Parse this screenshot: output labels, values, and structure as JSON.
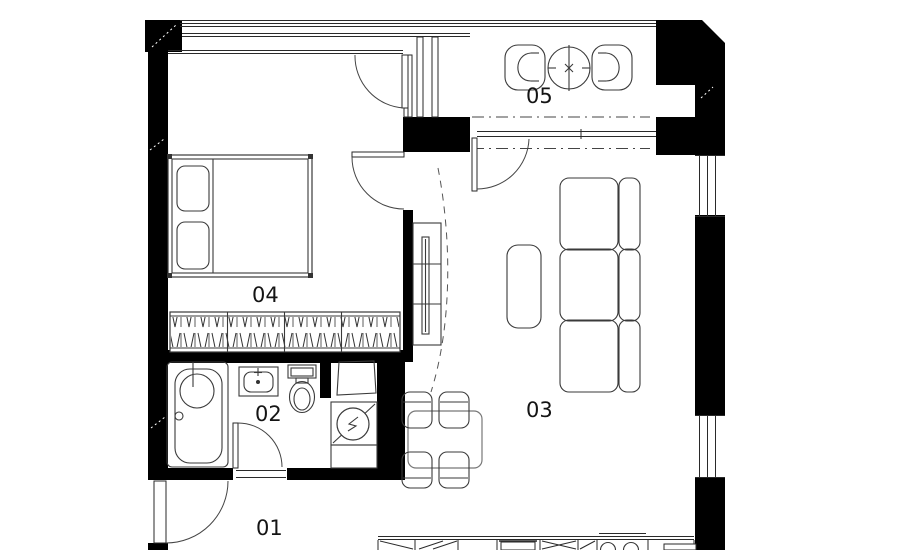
{
  "floor_plan": {
    "rooms": [
      {
        "label": "01"
      },
      {
        "label": "02"
      },
      {
        "label": "03"
      },
      {
        "label": "04"
      },
      {
        "label": "05"
      }
    ],
    "colors": {
      "wall": "#000000",
      "line": "#2a2a2a",
      "background": "#ffffff"
    },
    "furniture_symbols": [
      "double-bed",
      "pillow",
      "wardrobe-with-hangers",
      "bathtub",
      "washbasin",
      "toilet",
      "washing-machine",
      "water-heater",
      "dining-table",
      "dining-chair",
      "sofa",
      "coffee-table",
      "tv-cabinet",
      "balcony-chair",
      "balcony-round-table",
      "kitchen-counter",
      "kitchen-sink",
      "stove"
    ]
  }
}
